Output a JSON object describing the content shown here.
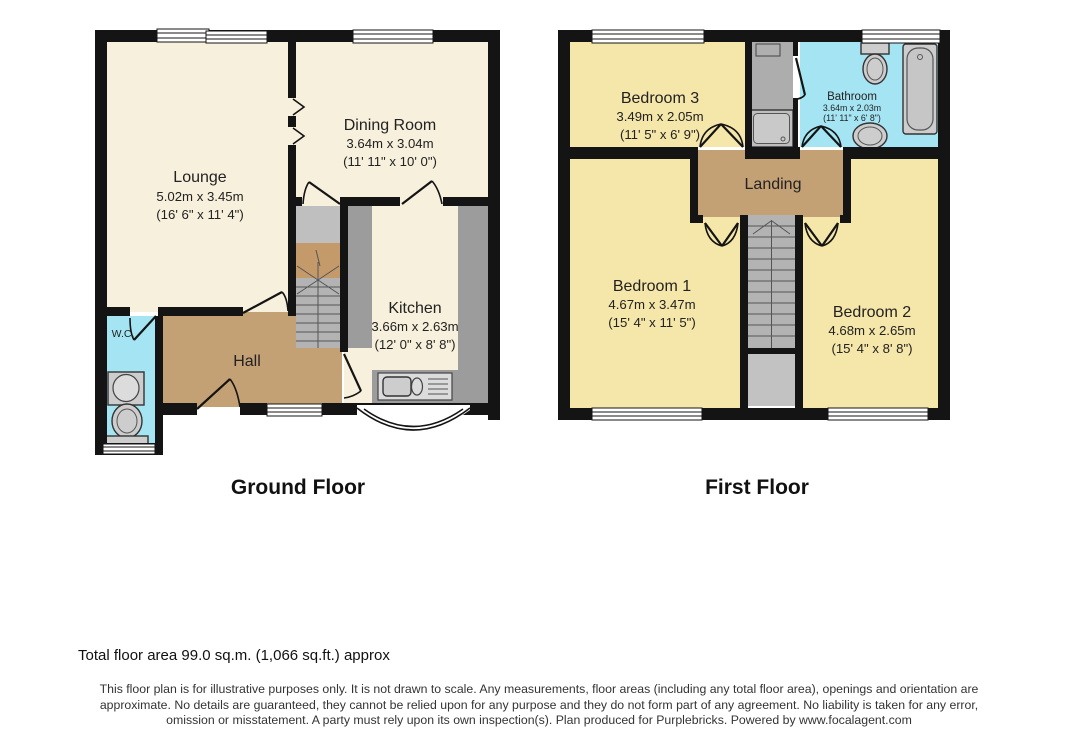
{
  "ground_floor": {
    "title": "Ground Floor",
    "rooms": {
      "lounge": {
        "name": "Lounge",
        "metric": "5.02m x 3.45m",
        "imperial": "(16' 6\" x 11' 4\")"
      },
      "dining": {
        "name": "Dining Room",
        "metric": "3.64m x 3.04m",
        "imperial": "(11' 11\" x 10' 0\")"
      },
      "kitchen": {
        "name": "Kitchen",
        "metric": "3.66m x 2.63m",
        "imperial": "(12' 0\" x 8' 8\")"
      },
      "hall": {
        "name": "Hall"
      },
      "wc": {
        "name": "W.C."
      }
    }
  },
  "first_floor": {
    "title": "First Floor",
    "rooms": {
      "bedroom1": {
        "name": "Bedroom 1",
        "metric": "4.67m x 3.47m",
        "imperial": "(15' 4\" x 11' 5\")"
      },
      "bedroom2": {
        "name": "Bedroom 2",
        "metric": "4.68m x 2.65m",
        "imperial": "(15' 4\" x 8' 8\")"
      },
      "bedroom3": {
        "name": "Bedroom 3",
        "metric": "3.49m x 2.05m",
        "imperial": "(11' 5\" x 6' 9\")"
      },
      "bathroom": {
        "name": "Bathroom",
        "metric": "3.64m x 2.03m",
        "imperial": "(11' 11\" x 6' 8\")"
      },
      "landing": {
        "name": "Landing"
      }
    }
  },
  "footer": {
    "total_area": "Total floor area 99.0 sq.m. (1,066 sq.ft.) approx",
    "disclaimer": "This floor plan is for illustrative purposes only. It is not drawn to scale. Any measurements, floor areas (including any total floor area), openings and orientation are approximate. No details are guaranteed, they cannot be relied upon for any purpose and they do not form part of any agreement. No liability is taken for any error, omission or misstatement. A party must rely upon its own inspection(s). Plan produced for Purplebricks. Powered by www.focalagent.com"
  },
  "colors": {
    "room_cream": "#F7F0DC",
    "room_yellow": "#F5E6A9",
    "hall_tan": "#C4A075",
    "stair_brown": "#C59A6B",
    "wet_room_cyan": "#A5E5F3",
    "counter_gray": "#9C9C9C",
    "stair_gray": "#B3B3B3",
    "cupboard_gray": "#C2C2C2",
    "wall_black": "#141414"
  }
}
